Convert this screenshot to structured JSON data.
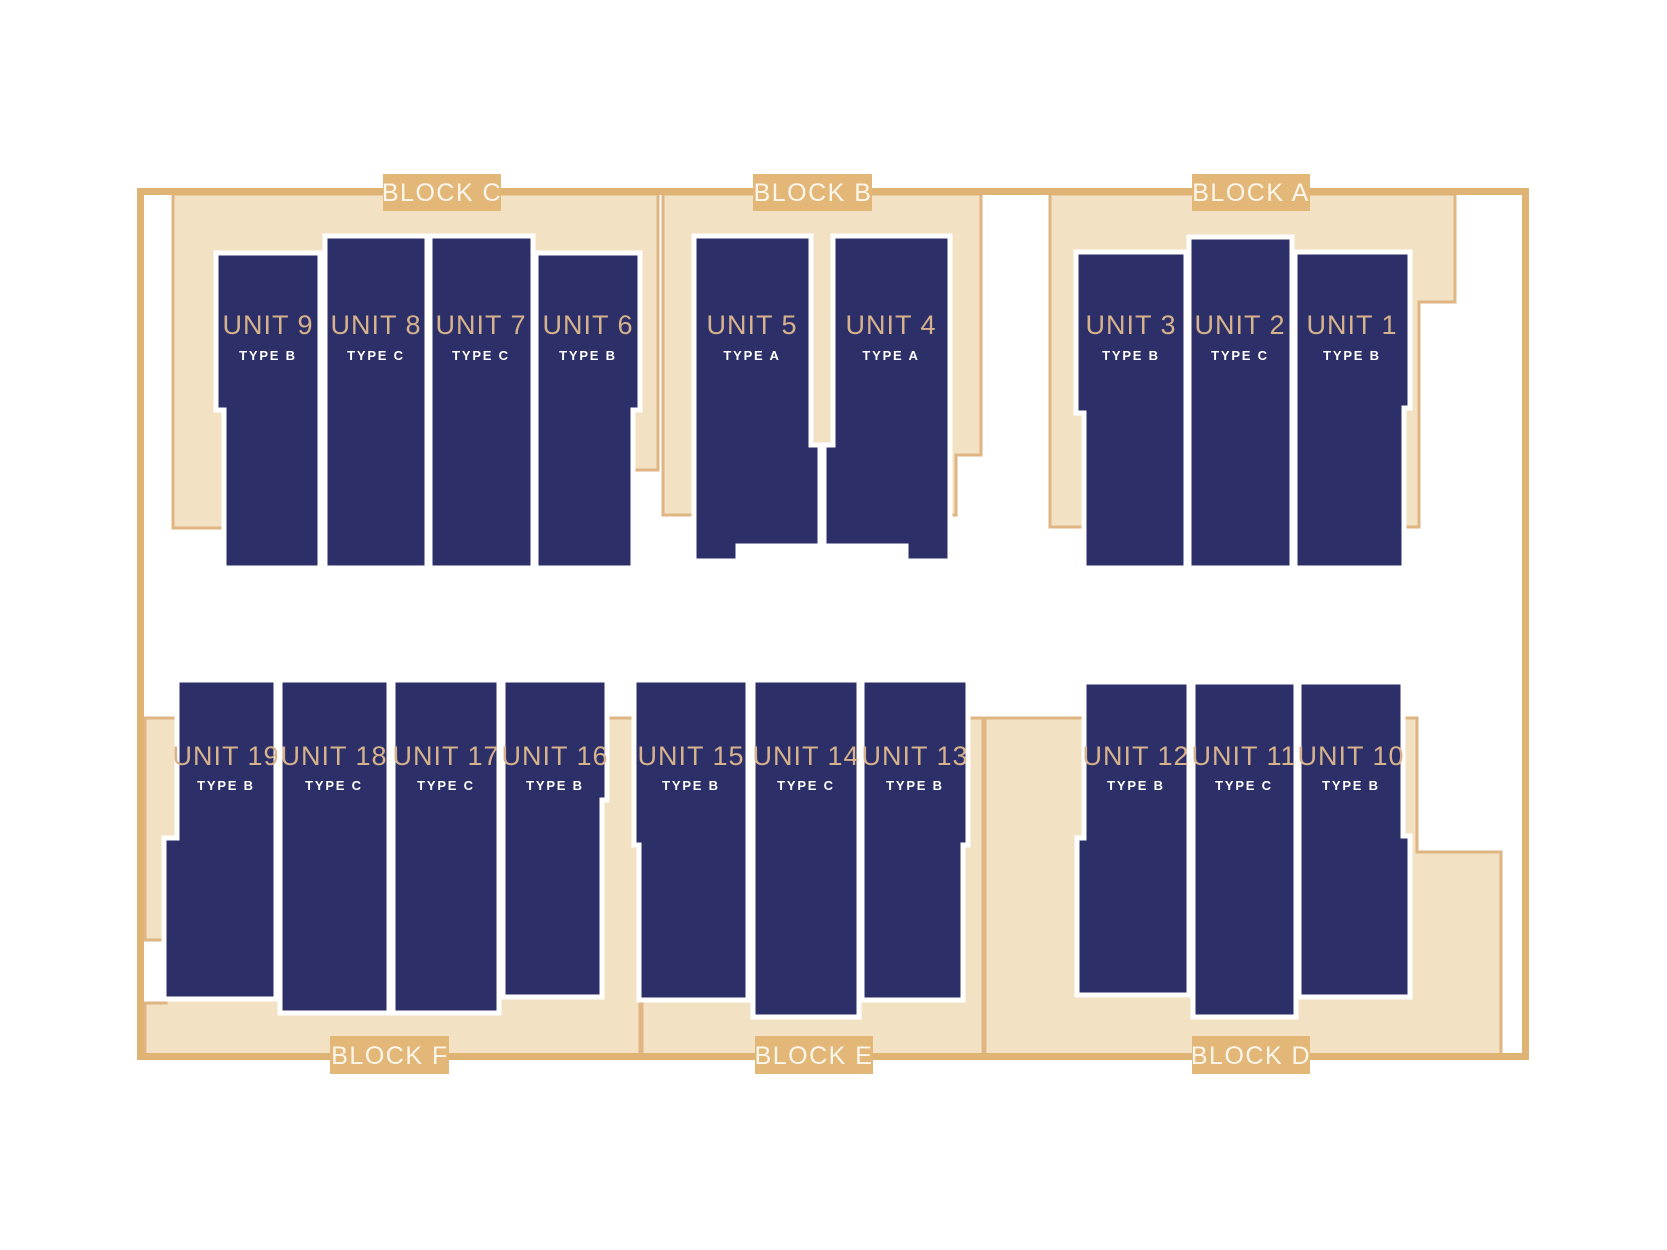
{
  "title": "Site plan",
  "colors": {
    "navy": "#2d2f68",
    "gold": "#d7b38c",
    "tan_fill": "#f3e1c3",
    "tan_stroke": "#dfb583",
    "boundary": "#dfb374",
    "tab_fill": "#e2b778",
    "tab_text": "#fbf6ec",
    "unit_outline": "#ffffff",
    "background": "#ffffff"
  },
  "blocks": [
    {
      "id": "A",
      "label": "BLOCK A"
    },
    {
      "id": "B",
      "label": "BLOCK B"
    },
    {
      "id": "C",
      "label": "BLOCK C"
    },
    {
      "id": "D",
      "label": "BLOCK D"
    },
    {
      "id": "E",
      "label": "BLOCK E"
    },
    {
      "id": "F",
      "label": "BLOCK F"
    }
  ],
  "units": [
    {
      "name": "UNIT 1",
      "type": "TYPE B"
    },
    {
      "name": "UNIT 2",
      "type": "TYPE C"
    },
    {
      "name": "UNIT 3",
      "type": "TYPE B"
    },
    {
      "name": "UNIT 4",
      "type": "TYPE A"
    },
    {
      "name": "UNIT 5",
      "type": "TYPE A"
    },
    {
      "name": "UNIT 6",
      "type": "TYPE B"
    },
    {
      "name": "UNIT 7",
      "type": "TYPE C"
    },
    {
      "name": "UNIT 8",
      "type": "TYPE C"
    },
    {
      "name": "UNIT 9",
      "type": "TYPE B"
    },
    {
      "name": "UNIT 10",
      "type": "TYPE B"
    },
    {
      "name": "UNIT 11",
      "type": "TYPE C"
    },
    {
      "name": "UNIT 12",
      "type": "TYPE B"
    },
    {
      "name": "UNIT 13",
      "type": "TYPE B"
    },
    {
      "name": "UNIT 14",
      "type": "TYPE C"
    },
    {
      "name": "UNIT 15",
      "type": "TYPE B"
    },
    {
      "name": "UNIT 16",
      "type": "TYPE B"
    },
    {
      "name": "UNIT 17",
      "type": "TYPE C"
    },
    {
      "name": "UNIT 18",
      "type": "TYPE C"
    },
    {
      "name": "UNIT 19",
      "type": "TYPE B"
    }
  ]
}
